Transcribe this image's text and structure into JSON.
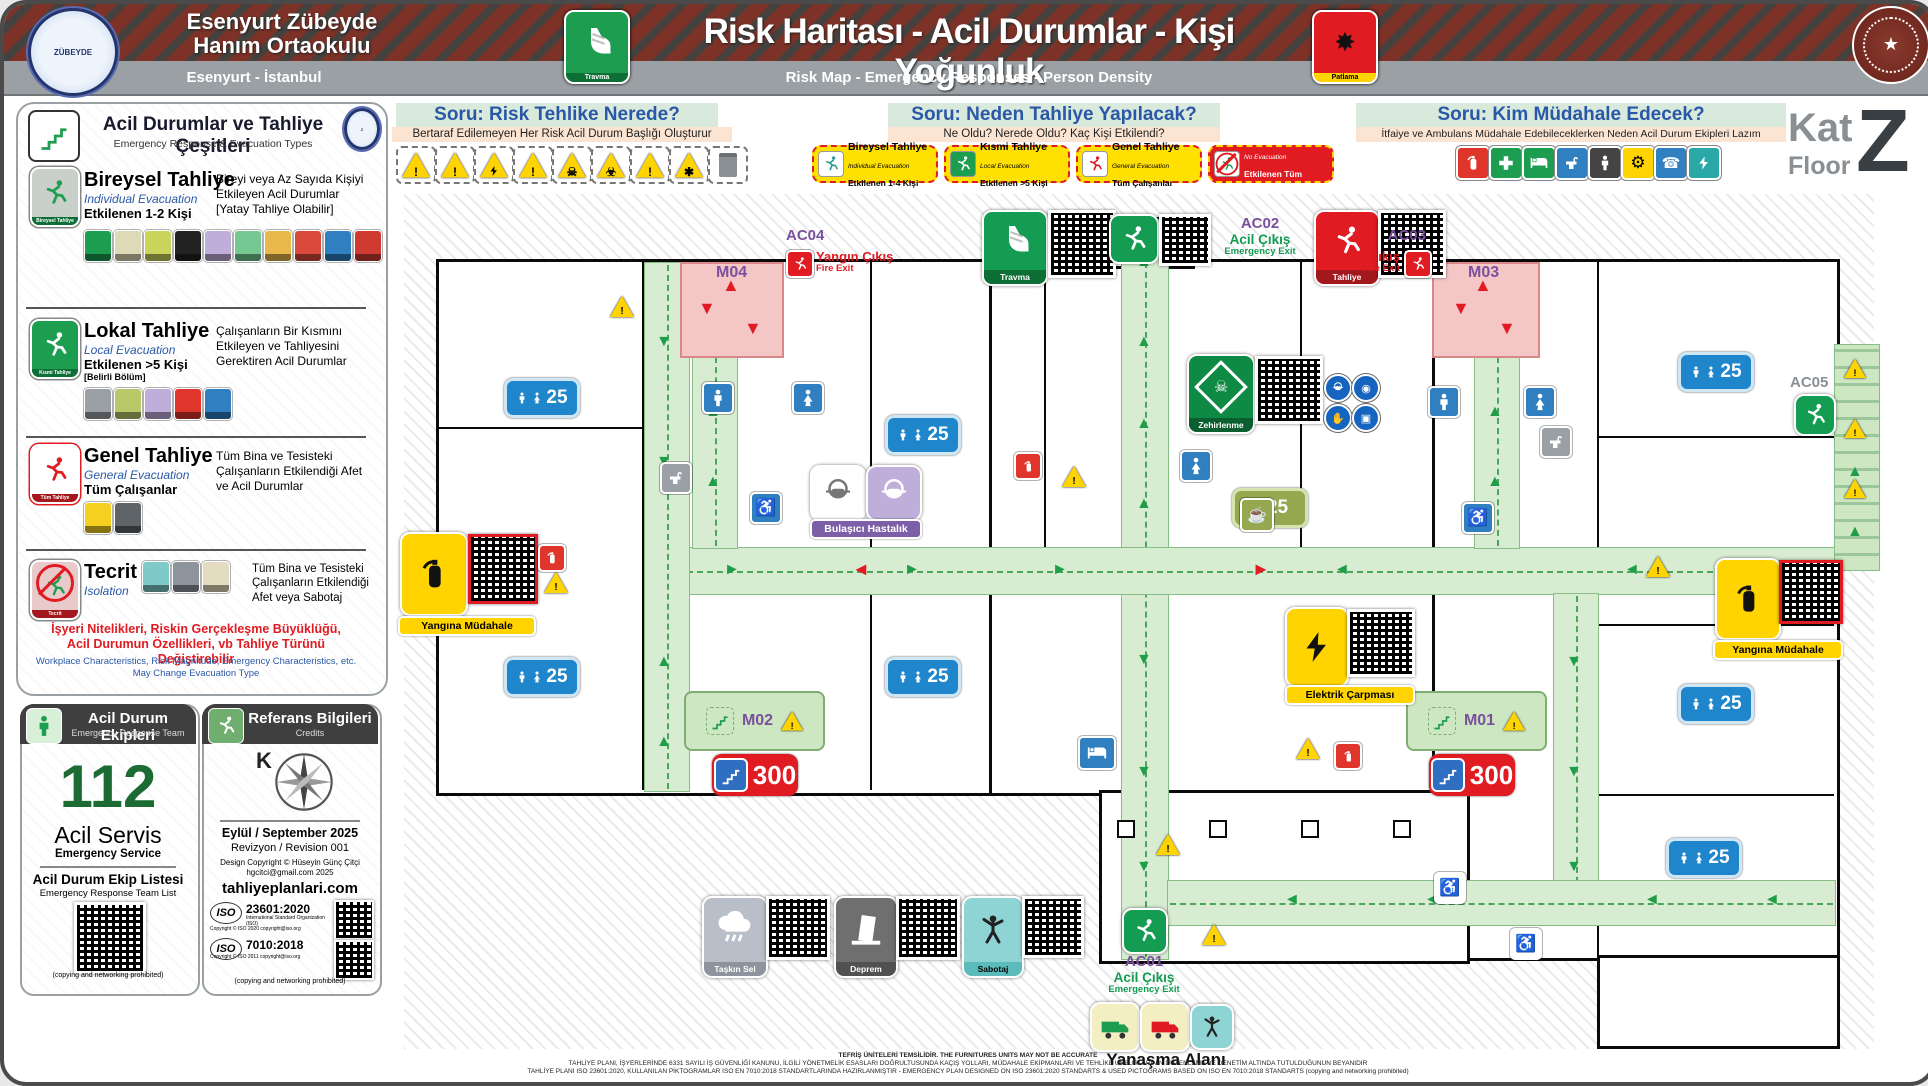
{
  "header": {
    "school_line1": "Esenyurt Zübeyde",
    "school_line2": "Hanım Ortaokulu",
    "location": "Esenyurt - İstanbul",
    "logo_text": "ZÜBEYDE",
    "title": "Risk Haritası - Acil Durumlar - Kişi Yoğunluk",
    "subtitle": "Risk Map - Emergency Responses - Person Density",
    "travma_caption": "Travma",
    "patlama_caption": "Patlama"
  },
  "floor_badge": {
    "kat": "Kat",
    "floor": "Floor",
    "letter": "Z"
  },
  "questions": [
    {
      "title": "Soru: Risk Tehlike Nerede?",
      "subtitle": "Bertaraf Edilemeyen Her Risk Acil Durum Başlığı Oluşturur"
    },
    {
      "title": "Soru: Neden Tahliye Yapılacak?",
      "subtitle": "Ne Oldu? Nerede Oldu? Kaç Kişi Etkilendi?"
    },
    {
      "title": "Soru: Kim Müdahale Edecek?",
      "subtitle": "İtfaiye ve Ambulans Müdahale Edebileceklerken Neden Acil Durum Ekipleri Lazım"
    }
  ],
  "evac_badges": [
    {
      "title": "Bireysel Tahliye",
      "sub": "Individual Evacuation",
      "scope": "Etkilenen 1-4 Kişi"
    },
    {
      "title": "Kısmi Tahliye",
      "sub": "Local Evacuation",
      "scope": "Etkilenen >5 Kişi"
    },
    {
      "title": "Genel Tahliye",
      "sub": "General Evacuation",
      "scope": "Tüm Çalışanlar"
    },
    {
      "title": "Tecrit",
      "sub": "No Evacuation",
      "scope": "Etkilenen Tüm Kişiler"
    }
  ],
  "sidebar": {
    "title": "Acil Durumlar ve Tahliye Çeşitleri",
    "subtitle": "Emergency Response & Evacuation Types",
    "sections": [
      {
        "title": "Bireysel Tahliye",
        "sub": "Individual Evacuation",
        "scope": "Etkilenen 1-2 Kişi",
        "scope2": "",
        "icon_caption": "Bireysel Tahliye",
        "desc": "Bireyi veya Az Sayıda Kişiyi Etkileyen Acil Durumlar [Yatay Tahliye Olabilir]"
      },
      {
        "title": "Lokal Tahliye",
        "sub": "Local Evacuation",
        "scope": "Etkilenen >5 Kişi",
        "scope2": "[Belirli Bölüm]",
        "icon_caption": "Kısmi Tahliye",
        "desc": "Çalışanların Bir Kısmını Etkileyen ve Tahliyesini Gerektiren Acil Durumlar"
      },
      {
        "title": "Genel Tahliye",
        "sub": "General Evacuation",
        "scope": "Tüm Çalışanlar",
        "scope2": "",
        "icon_caption": "Tüm Tahliye",
        "desc": "Tüm Bina ve Tesisteki Çalışanların Etkilendiği Afet ve Acil Durumlar"
      },
      {
        "title": "Tecrit",
        "sub": "Isolation",
        "scope": "",
        "scope2": "",
        "icon_caption": "Tecrit",
        "desc": "Tüm Bina ve Tesisteki Çalışanların Etkilendiği Afet veya Sabotaj"
      }
    ],
    "note_tr1": "İşyeri Nitelikleri, Riskin Gerçekleşme Büyüklüğü,",
    "note_tr2": "Acil Durumun Özellikleri, vb Tahliye Türünü Değiştirebilir",
    "note_en1": "Workplace Characteristics, Risk Magnitude, Emergency Characteristics, etc.",
    "note_en2": "May Change Evacuation Type"
  },
  "team_panel": {
    "title": "Acil Durum Ekipleri",
    "subtitle": "Emergency Response Team",
    "number": "112",
    "service_tr": "Acil Servis",
    "service_en": "Emergency Service",
    "list_tr": "Acil Durum Ekip Listesi",
    "list_en": "Emergency Response Team List",
    "note": "(copying and networking prohibited)"
  },
  "credits_panel": {
    "title": "Referans Bilgileri",
    "subtitle": "Credits",
    "north": "K",
    "date": "Eylül / September 2025",
    "revision": "Revizyon / Revision 001",
    "design": "Design Copyright © Hüseyin Günç Çitçi",
    "email": "hgcitci@gmail.com 2025",
    "site": "tahliyeplanlari.com",
    "iso1": "23601:2020",
    "iso2": "7010:2018",
    "iso_org": "International Standard Organization (ISO)",
    "iso1_copy": "Copyright © ISO 2020 copyright@iso.org",
    "iso2_copy": "Copyright © ISO 2011 copyright@iso.org",
    "note": "(copying and networking prohibited)"
  },
  "map": {
    "exits": {
      "ac01": {
        "id": "AC01",
        "tr": "Acil Çıkış",
        "en": "Emergency Exit"
      },
      "ac02": {
        "id": "AC02",
        "tr": "Acil Çıkış",
        "en": "Emergency Exit"
      },
      "ac03": {
        "id": "AC03",
        "tr": "Yangın Çıkış",
        "en": "Fire Exit"
      },
      "ac04": {
        "id": "AC04",
        "tr": "Yangın Çıkış",
        "en": "Fire Exit"
      },
      "ac05": {
        "id": "AC05"
      }
    },
    "stairs": {
      "m01": "M01",
      "m02": "M02",
      "m03": "M03",
      "m04": "M04"
    },
    "signs": {
      "travma": "Travma",
      "tahliye": "Tahliye",
      "zehirlenme": "Zehirlenme",
      "bulasici": "Bulaşıcı Hastalık",
      "yangina": "Yangına Müdahale",
      "elektrik": "Elektrik Çarpması",
      "taskin": "Taşkın Sel",
      "deprem": "Deprem",
      "sabotaj": "Sabotaj"
    },
    "density": [
      {
        "value": "25"
      },
      {
        "value": "25"
      },
      {
        "value": "25"
      },
      {
        "value": "25"
      },
      {
        "value": "25"
      },
      {
        "value": "25"
      },
      {
        "value": "25"
      },
      {
        "value": "25"
      }
    ],
    "capacity": [
      {
        "value": "300"
      },
      {
        "value": "300"
      }
    ],
    "approach": "Yanaşma Alanı"
  },
  "footer": {
    "line1": "TEFRİŞ ÜNİTELERİ TEMSİLİDİR. THE FURNITURES UNITS MAY NOT BE ACCURATE",
    "line2": "TAHLİYE PLANI, İŞYERLERİNDE 6331 SAYILI İŞ GÜVENLİĞİ KANUNU, İLGİLİ YÖNETMELİK ESASLARI DOĞRULTUSUNDA KAÇIŞ YOLLARI, MÜDAHALE EKİPMANLARI VE TEHLİKE UNSURLARININ DÜZENLEME VE DENETİM ALTINDA TUTULDUĞUNUN BEYANIDIR",
    "line3": "TAHLİYE PLANI ISO 23601:2020, KULLANILAN PİKTOGRAMLAR ISO EN 7010:2018 STANDARTLARINDA HAZIRLANMIŞTIR - EMERGENCY PLAN DESIGNED ON ISO 23601:2020 STANDARTS & USED PICTOGRAMS BASED ON ISO EN 7010:2018 STANDARTS (copying and networking prohibited)"
  }
}
